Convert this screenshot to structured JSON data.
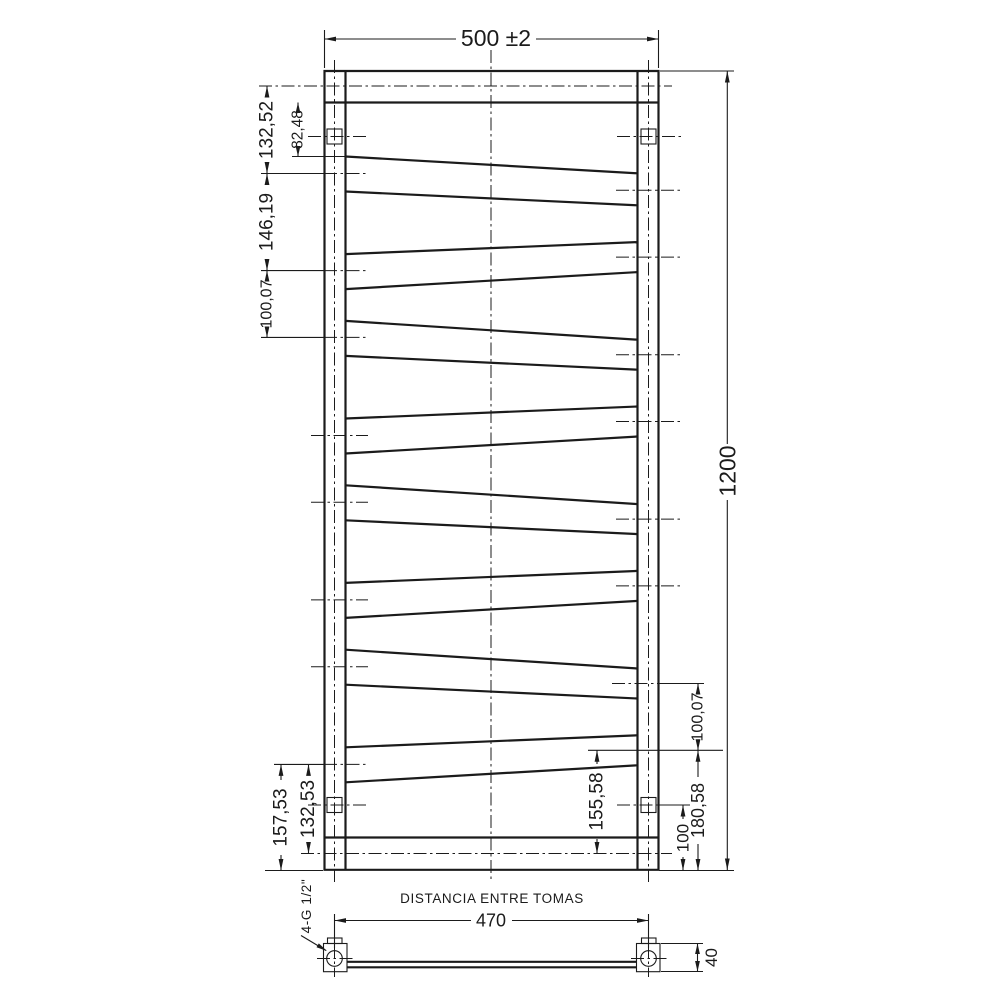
{
  "drawing": {
    "type": "technical-dimension-drawing",
    "subject": "zigzag towel radiator front and bottom views",
    "colors": {
      "ink": "#1b1b1b",
      "background": "#ffffff"
    },
    "labels": {
      "dim_width": "500 ±2",
      "dim_height": "1200",
      "dim_l_132_52": "132,52",
      "dim_l_82_48": "82,48",
      "dim_l_146_19": "146,19",
      "dim_l_100_07": "100,07",
      "dim_bl_157_53": "157,53",
      "dim_bl_132_53": "132,53",
      "dim_br_100_07": "100,07",
      "dim_br_155_58": "155,58",
      "dim_br_180_58": "180,58",
      "dim_br_100": "100",
      "plan_title": "DISTANCIA ENTRE TOMAS",
      "plan_span": "470",
      "plan_depth": "40",
      "plan_thread": "4-G 1/2\""
    }
  }
}
